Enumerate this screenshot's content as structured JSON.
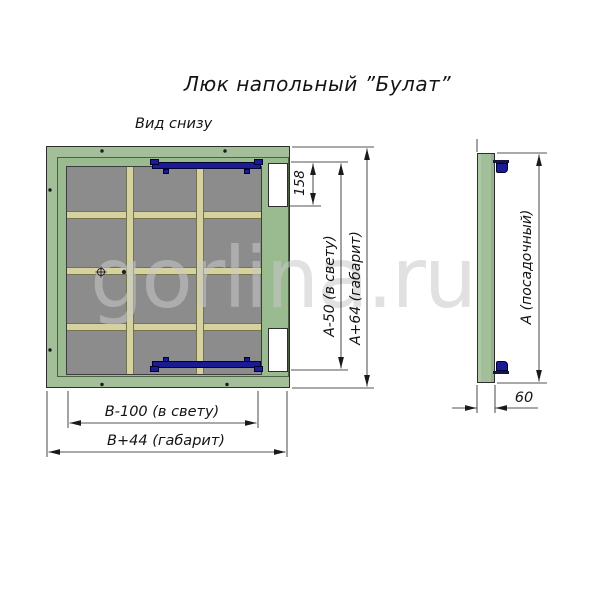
{
  "title": "Люк напольный ”Булат”",
  "bottom_view": {
    "label": "Вид снизу",
    "dims": {
      "recess_height": "158",
      "clear_height": "А-50 (в свету)",
      "overall_height": "А+64 (габарит)",
      "clear_width": "В-100 (в свету)",
      "overall_width": "В+44 (габарит)"
    }
  },
  "side_view": {
    "dims": {
      "seat_height": "А (посадочный)",
      "depth": "60"
    }
  },
  "watermark": "gorlina.ru",
  "colors": {
    "frame_green": "#a2bf99",
    "frame_green_light": "#9aba90",
    "panel_gray": "#8c8c8c",
    "rib_beige": "#d6d2a0",
    "hinge_navy": "#1b1b94",
    "line": "#1a1a1a",
    "watermark": "rgba(200,200,200,0.55)"
  }
}
